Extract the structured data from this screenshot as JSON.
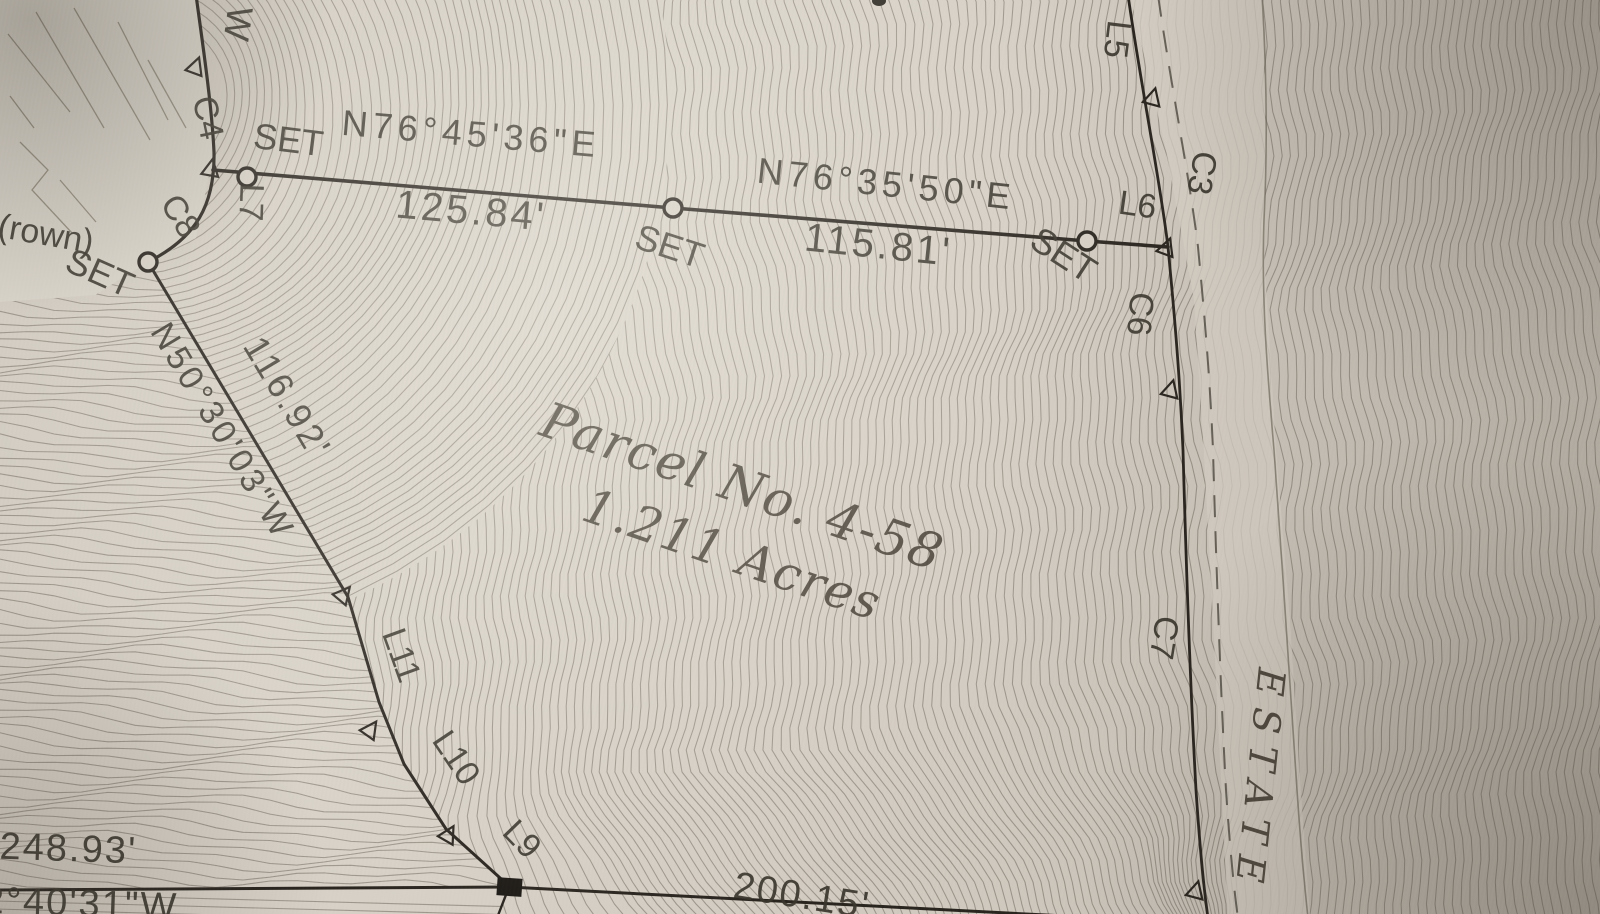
{
  "labels": {
    "points": {
      "set1": "SET",
      "set2": "SET",
      "set3": "SET",
      "set4": "SET"
    },
    "bearings": {
      "b1": "N76°45'36\"E",
      "d1": "125.84'",
      "b2": "N76°35'50\"E",
      "d2": "115.81'",
      "b3": "N50°30'03\"W",
      "d3": "116.92'",
      "d4": "248.93'",
      "b4": "2°40'31\"W",
      "d5": "200.15'"
    },
    "curves": {
      "c3": "C3",
      "c4": "C4",
      "c6": "C6",
      "c7": "C7",
      "c8": "C8"
    },
    "lines": {
      "l5": "L5",
      "l6": "L6",
      "l7": "L7",
      "l9": "L9",
      "l10": "L10",
      "l11": "L11",
      "w": "W"
    },
    "parcel": {
      "name": "Parcel No. 4-58",
      "area": "1.211 Acres"
    },
    "road": {
      "name": "ESTATE"
    },
    "notes": {
      "n1": "(rown)"
    }
  },
  "colors": {
    "paper": "#d4cec4",
    "contour": "#6f685d",
    "boundary": "#29241e",
    "ink": "#3a352c"
  }
}
